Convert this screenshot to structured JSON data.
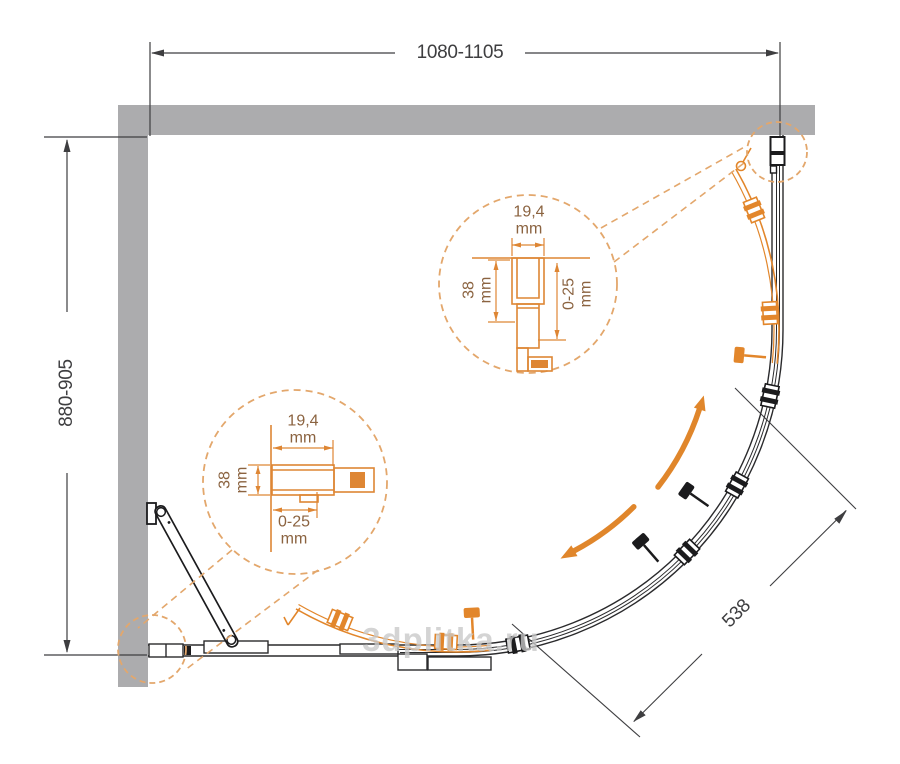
{
  "dimensions": {
    "top": "1080-1105",
    "left": "880-905",
    "diagonal": "538"
  },
  "detail_labels": {
    "profile_width": "19,4",
    "profile_depth": "38",
    "adjustment": "0-25",
    "unit": "mm"
  },
  "watermark": "3dplitka.ru",
  "colors": {
    "accent_orange": "#e2862b",
    "accent_soft_orange": "#e3a76c",
    "wall_gray": "#acacae",
    "line_dark": "#3e3e40",
    "detail_text_brown": "#8b6340",
    "watermark_gray": "#c9c9c9"
  }
}
